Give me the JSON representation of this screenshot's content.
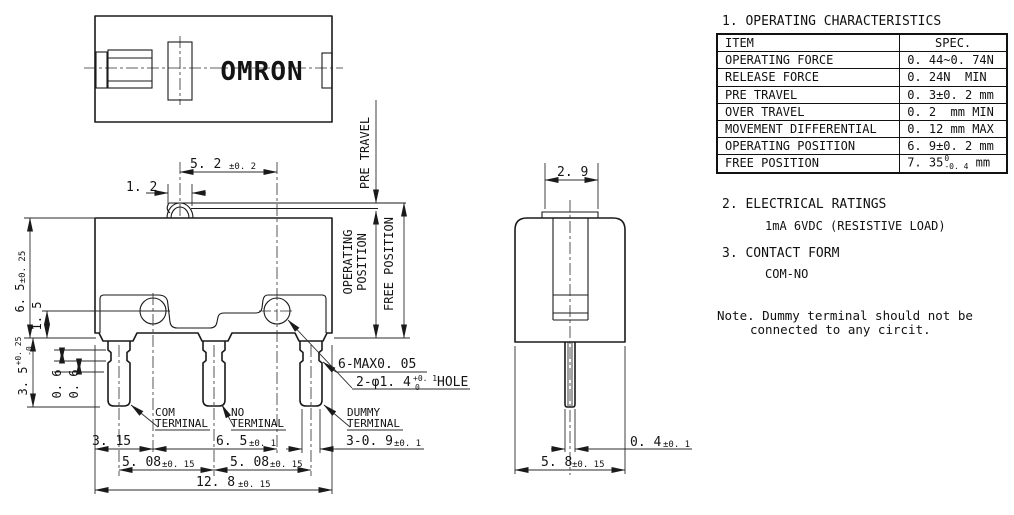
{
  "colors": {
    "line": "#1a1a1a",
    "bg": "#ffffff"
  },
  "drawing": {
    "logo": "OMRON",
    "dims": {
      "top_width": {
        "v": "5. 2",
        "t": "±0. 2"
      },
      "lever_offset": "1. 2",
      "pre_travel": "PRE TRAVEL",
      "op_pos_1": "OPERATING",
      "op_pos_2": "POSITION",
      "free_pos": "FREE POSITION",
      "body_height": {
        "v": "6. 5",
        "t": "±0. 25"
      },
      "hole_bottom": "1. 5",
      "terminal_len": {
        "v": "3. 5",
        "sup": "+0. 25",
        "sub": "-0"
      },
      "step1": "0. 6",
      "step2": "0. 6",
      "com": {
        "l1": "COM",
        "l2": "TERMINAL"
      },
      "no": {
        "l1": "NO",
        "l2": "TERMINAL"
      },
      "dummy": {
        "l1": "DUMMY",
        "l2": "TERMINAL"
      },
      "burr": "6-MAX0. 05",
      "hole": {
        "v": "2-φ1. 4",
        "sup": "+0. 1",
        "sub": "0",
        "suffix": "HOLE"
      },
      "hole_offset": "3. 15",
      "hole_pitch": {
        "v": "6. 5",
        "t": "±0. 1"
      },
      "term_width": {
        "v": "3-0. 9",
        "t": "±0. 1"
      },
      "pitch1": {
        "v": "5. 08",
        "t": "±0. 15"
      },
      "pitch2": {
        "v": "5. 08",
        "t": "±0. 15"
      },
      "total_width": {
        "v": "12. 8",
        "t": "±0. 15"
      },
      "plunger_width": "2. 9",
      "pin_thick": {
        "v": "0. 4",
        "t": "±0. 1"
      },
      "end_width": {
        "v": "5. 8",
        "t": "±0. 15"
      }
    }
  },
  "characteristics": {
    "heading": "1. OPERATING CHARACTERISTICS",
    "table": {
      "headers": [
        "ITEM",
        "SPEC."
      ],
      "rows": [
        {
          "item": "OPERATING FORCE",
          "spec": "0. 44~0. 74N"
        },
        {
          "item": "RELEASE FORCE",
          "spec": "0. 24N  MIN"
        },
        {
          "item": "PRE TRAVEL",
          "spec": "0. 3±0. 2 mm"
        },
        {
          "item": "OVER TRAVEL",
          "spec": "0. 2  mm MIN"
        },
        {
          "item": "MOVEMENT DIFFERENTIAL",
          "spec": "0. 12 mm MAX"
        },
        {
          "item": "OPERATING POSITION",
          "spec": "6. 9±0. 2 mm"
        },
        {
          "item": "FREE POSITION",
          "spec": "7. 35",
          "sup": "0",
          "sub": "-0. 4",
          "unit": "mm"
        }
      ]
    }
  },
  "electrical": {
    "heading": "2. ELECTRICAL RATINGS",
    "value": "1mA 6VDC (RESISTIVE LOAD)"
  },
  "contact": {
    "heading": "3. CONTACT FORM",
    "value": "COM-NO"
  },
  "note": {
    "line1": "Note. Dummy terminal should not be",
    "line2": "connected to any circit."
  }
}
